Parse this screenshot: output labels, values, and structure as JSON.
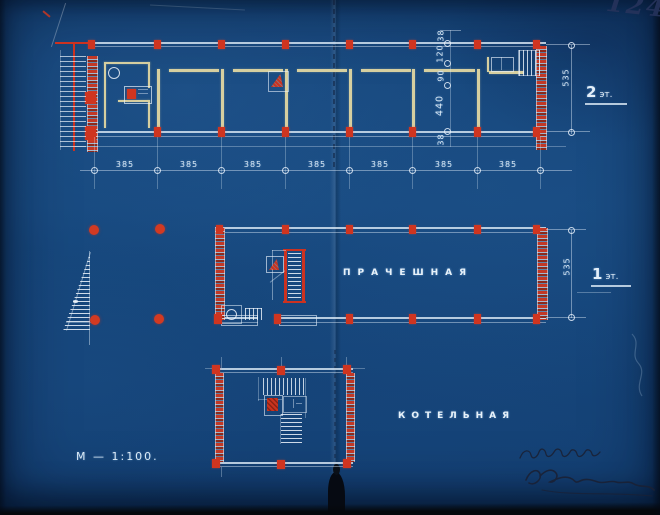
{
  "document": {
    "page_number": "124",
    "scale_label": "М — 1:100."
  },
  "plans": {
    "floor2": {
      "label_num": "2",
      "label_suffix": "эт."
    },
    "floor1": {
      "label_num": "1",
      "label_suffix": "эт.",
      "room_label": "ПРАЧЕШНАЯ"
    },
    "basement": {
      "room_label": "КОТЕЛЬНАЯ"
    }
  },
  "dimensions": {
    "bay": "385",
    "depth_floor2": "535",
    "depth_floor1": "535",
    "chain_top": "38",
    "chain_a": "120",
    "chain_b": "90",
    "chain_main": "440",
    "chain_bottom": "38"
  },
  "colors": {
    "paper_blue": "#16477B",
    "line_white": "#DCEAF6",
    "wall_cream": "#D6CFA0",
    "marking_red": "#CC3220",
    "ink_dark": "#243055"
  }
}
